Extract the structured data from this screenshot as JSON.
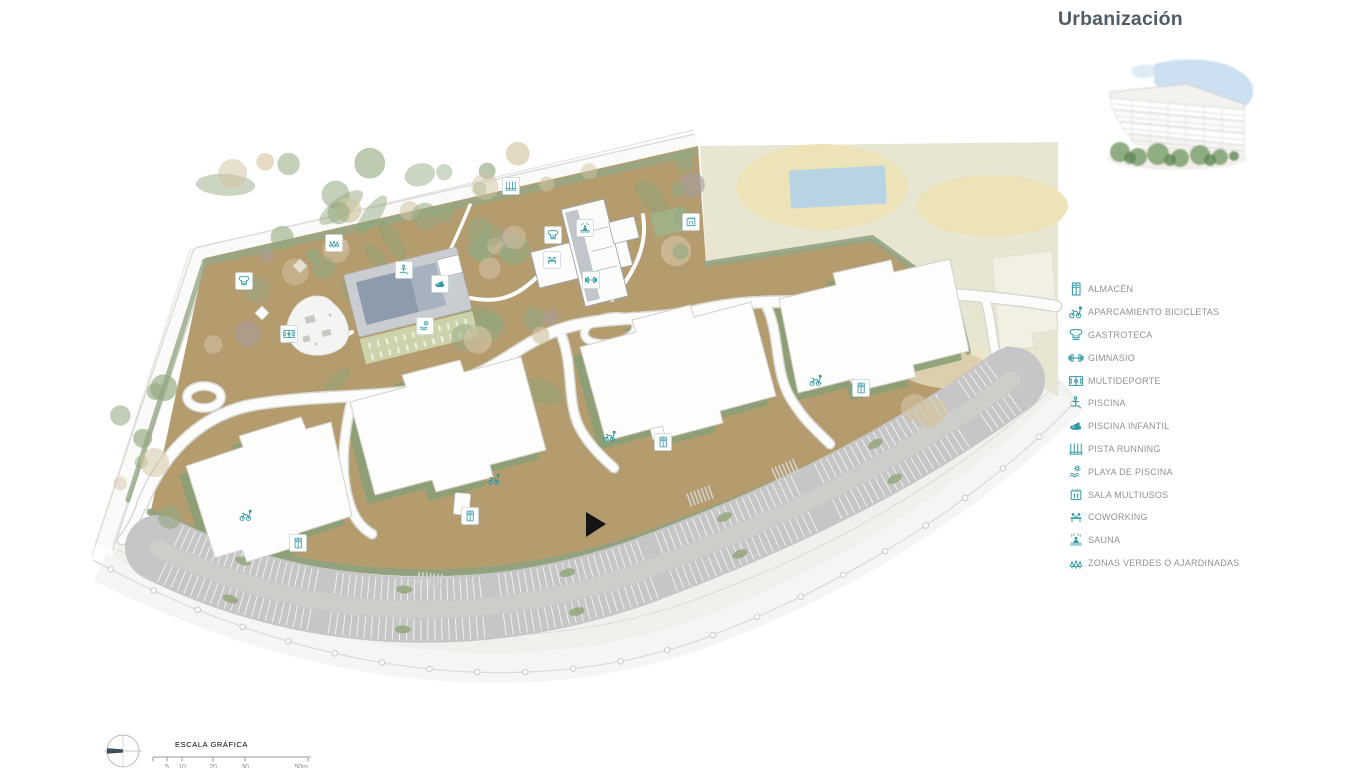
{
  "legend": {
    "title": "Urbanización",
    "items": [
      {
        "icon": "almacen",
        "label": "ALMACÉN"
      },
      {
        "icon": "aparcamiento-bicicletas",
        "label": "APARCAMIENTO BICICLETAS"
      },
      {
        "icon": "gastroteca",
        "label": "GASTROTECA"
      },
      {
        "icon": "gimnasio",
        "label": "GIMNASIO"
      },
      {
        "icon": "multideporte",
        "label": "MULTIDEPORTE"
      },
      {
        "icon": "piscina",
        "label": "PISCINA"
      },
      {
        "icon": "piscina-infantil",
        "label": "PISCINA INFANTIL"
      },
      {
        "icon": "pista-running",
        "label": "PISTA RUNNING"
      },
      {
        "icon": "playa-de-piscina",
        "label": "PLAYA DE PISCINA"
      },
      {
        "icon": "sala-multiusos",
        "label": "SALA MULTIUSOS"
      },
      {
        "icon": "coworking",
        "label": "COWORKING"
      },
      {
        "icon": "sauna",
        "label": "SAUNA"
      },
      {
        "icon": "zonas-verdes",
        "label": "ZONAS VERDES O AJARDINADAS"
      }
    ]
  },
  "scale_bar": {
    "title": "ESCALA GRÁFICA",
    "ticks": [
      "5",
      "10",
      "20",
      "30",
      "50m"
    ]
  },
  "map": {
    "badges": [
      {
        "icon": "pista-running",
        "x": 511,
        "y": 186,
        "boxed": true
      },
      {
        "icon": "zonas-verdes",
        "x": 334,
        "y": 243,
        "boxed": true
      },
      {
        "icon": "gastroteca",
        "x": 244,
        "y": 281,
        "boxed": true
      },
      {
        "icon": "multideporte",
        "x": 289,
        "y": 334,
        "boxed": true
      },
      {
        "icon": "piscina",
        "x": 404,
        "y": 270,
        "boxed": true
      },
      {
        "icon": "piscina-infantil",
        "x": 440,
        "y": 284,
        "boxed": true
      },
      {
        "icon": "playa-de-piscina",
        "x": 425,
        "y": 326,
        "boxed": true
      },
      {
        "icon": "gastroteca",
        "x": 553,
        "y": 235,
        "boxed": true
      },
      {
        "icon": "sauna",
        "x": 585,
        "y": 228,
        "boxed": true
      },
      {
        "icon": "coworking",
        "x": 552,
        "y": 260,
        "boxed": true
      },
      {
        "icon": "gimnasio",
        "x": 591,
        "y": 280,
        "boxed": true
      },
      {
        "icon": "sala-multiusos",
        "x": 691,
        "y": 222,
        "boxed": true
      },
      {
        "icon": "aparcamiento-bicicletas",
        "x": 246,
        "y": 515,
        "boxed": false
      },
      {
        "icon": "almacen",
        "x": 298,
        "y": 543,
        "boxed": true
      },
      {
        "icon": "aparcamiento-bicicletas",
        "x": 494,
        "y": 479,
        "boxed": false
      },
      {
        "icon": "almacen",
        "x": 470,
        "y": 516,
        "boxed": true
      },
      {
        "icon": "aparcamiento-bicicletas",
        "x": 610,
        "y": 436,
        "boxed": false
      },
      {
        "icon": "almacen",
        "x": 663,
        "y": 442,
        "boxed": true
      },
      {
        "icon": "aparcamiento-bicicletas",
        "x": 816,
        "y": 380,
        "boxed": false
      },
      {
        "icon": "almacen",
        "x": 861,
        "y": 388,
        "boxed": true
      }
    ]
  },
  "colors": {
    "accent_teal": "#2e97a3",
    "title_color": "#4e5d68",
    "label_gray": "#8d9296",
    "ground_tan": "#b59c6f",
    "hedge_green": "#93a583",
    "cream": "#e9e5d3",
    "water_blue": "#b7d3e4",
    "pool_water": "#8e9bad",
    "parking_gray": "#c6c6c6"
  }
}
